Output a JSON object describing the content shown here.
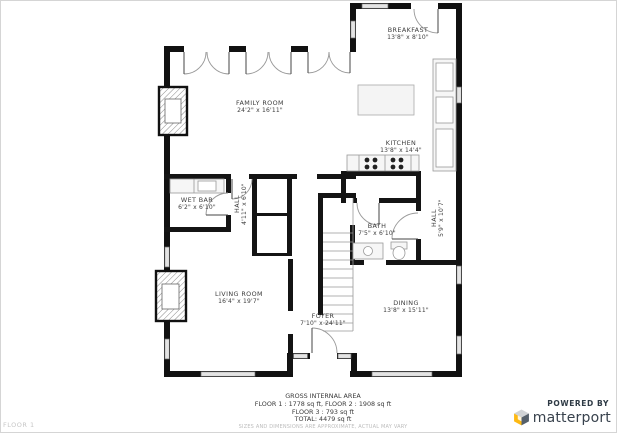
{
  "floorplan": {
    "floor_label": "FLOOR 1",
    "rooms": [
      {
        "name": "BREAKFAST",
        "dims": "13'8\" x 8'10\""
      },
      {
        "name": "FAMILY ROOM",
        "dims": "24'2\" x 16'11\""
      },
      {
        "name": "KITCHEN",
        "dims": "13'8\" x 14'4\""
      },
      {
        "name": "WET BAR",
        "dims": "6'2\" x 6'10\""
      },
      {
        "name": "HALL",
        "dims": "4'11\" x 6'10\""
      },
      {
        "name": "BATH",
        "dims": "7'5\" x 6'10\""
      },
      {
        "name": "HALL",
        "dims": "5'9\" x 10'7\""
      },
      {
        "name": "LIVING ROOM",
        "dims": "16'4\" x 19'7\""
      },
      {
        "name": "FOYER",
        "dims": "7'10\" x 24'11\""
      },
      {
        "name": "DINING",
        "dims": "13'8\" x 15'11\""
      }
    ],
    "wall_color": "#111111",
    "window_color": "#e4e4e4"
  },
  "footer": {
    "title": "GROSS INTERNAL AREA",
    "line1": "FLOOR 1 : 1778 sq ft, FLOOR 2 : 1908 sq ft",
    "line2": "FLOOR 3 : 793 sq ft",
    "line3": "TOTAL: 4479 sq ft",
    "disclaimer": "SIZES AND DIMENSIONS ARE APPROXIMATE, ACTUAL MAY VARY"
  },
  "branding": {
    "powered_by": "POWERED BY",
    "brand": "matterport",
    "brand_text_color": "#38424d",
    "logo_yellow": "#fdb913",
    "logo_gray": "#d0d3d6",
    "logo_dark": "#55606b"
  }
}
